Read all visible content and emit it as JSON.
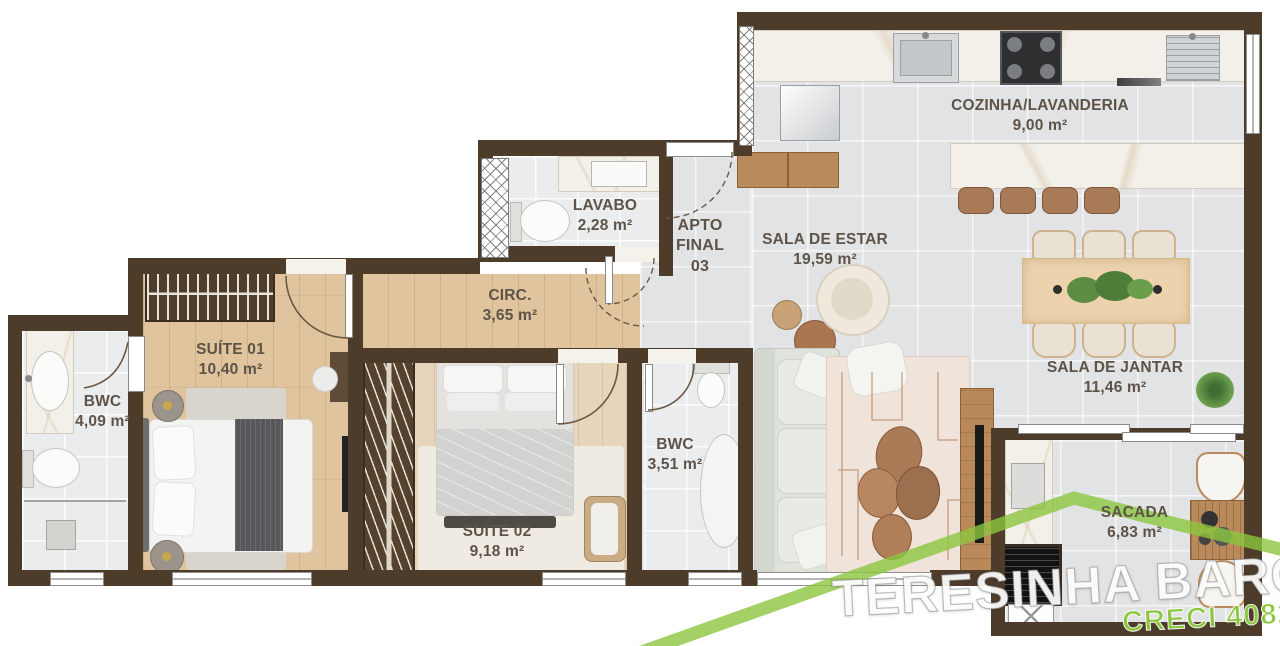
{
  "unit": {
    "line1": "APTO",
    "line2": "FINAL",
    "line3": "03"
  },
  "rooms": {
    "cozinha": {
      "name": "COZINHA/LAVANDERIA",
      "area": "9,00 m²"
    },
    "lavabo": {
      "name": "LAVABO",
      "area": "2,28 m²"
    },
    "sala_estar": {
      "name": "SALA DE ESTAR",
      "area": "19,59 m²"
    },
    "circulacao": {
      "name": "CIRC.",
      "area": "3,65 m²"
    },
    "suite01": {
      "name": "SUÍTE 01",
      "area": "10,40 m²"
    },
    "bwc_suite": {
      "name": "BWC",
      "area": "4,09 m²"
    },
    "suite02": {
      "name": "SUÍTE 02",
      "area": "9,18 m²"
    },
    "bwc_social": {
      "name": "BWC",
      "area": "3,51 m²"
    },
    "sala_jantar": {
      "name": "SALA DE JANTAR",
      "area": "11,46 m²"
    },
    "sacada": {
      "name": "SACADA",
      "area": "6,83 m²"
    }
  },
  "watermark": {
    "brand": "TERESINHA BARON",
    "creci": "CRECI 4082"
  },
  "palette": {
    "wall": "#4e3c2b",
    "wood_floor": "#e0c49d",
    "tile_floor": "#e2e3e5",
    "marble": "#f3f0e9",
    "watermark_green": "#8cc63e",
    "label_text": "#5d5348"
  }
}
